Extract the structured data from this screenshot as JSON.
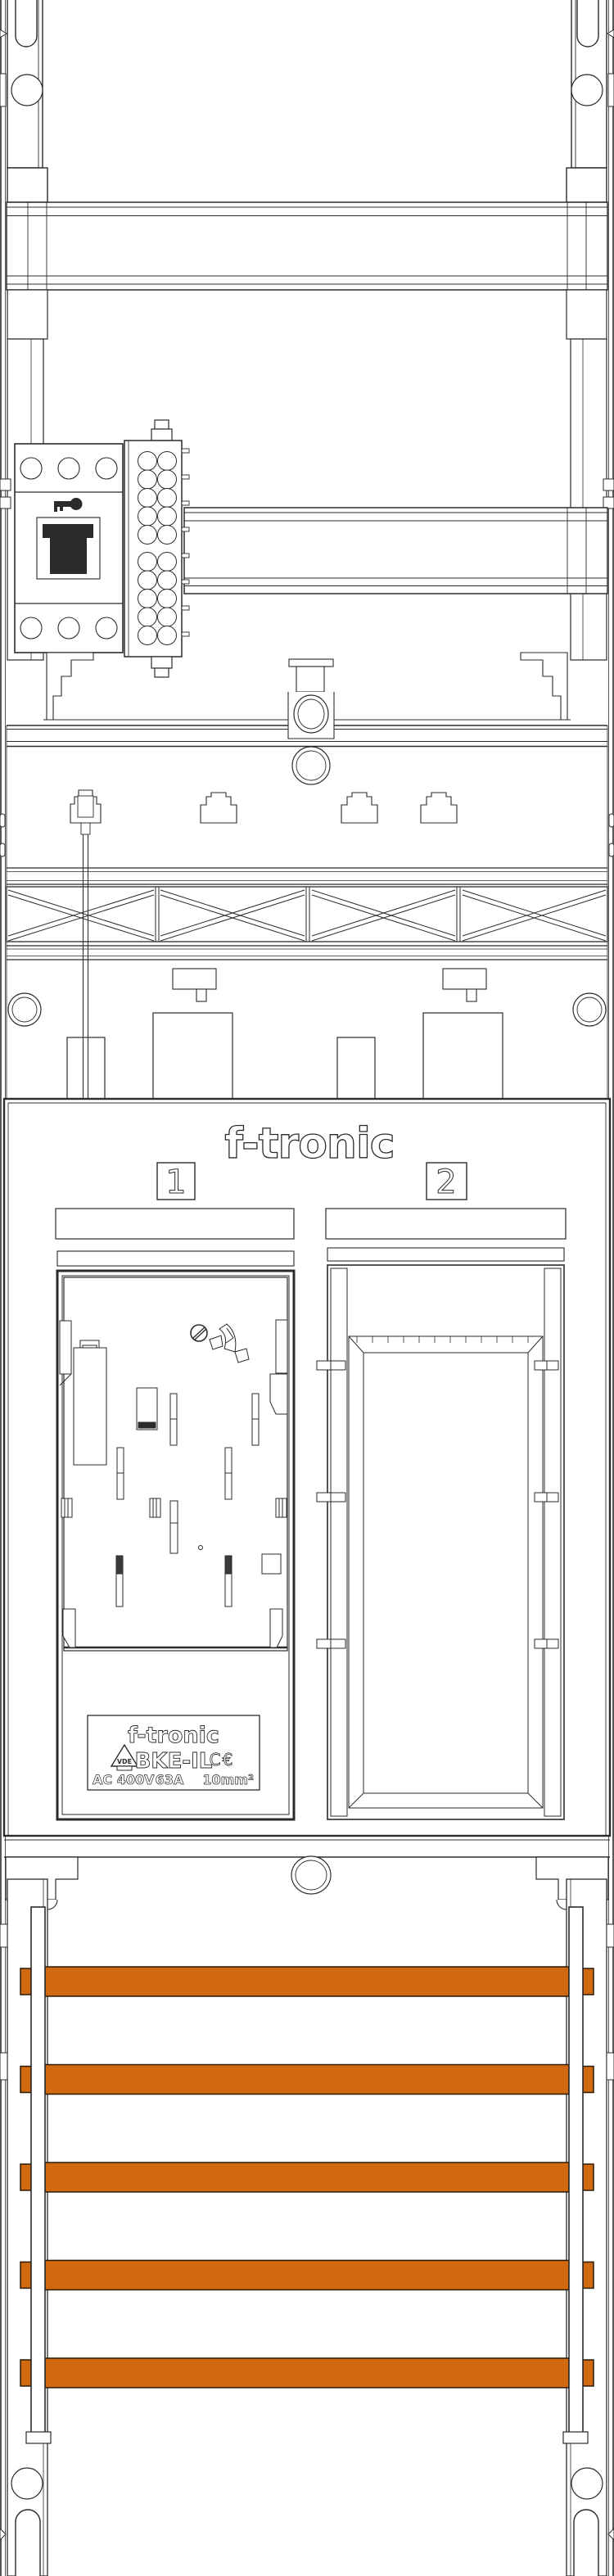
{
  "brand_logo": "f-tronic",
  "field_tags": {
    "left": "1",
    "right": "2"
  },
  "nameplate": {
    "brand": "f-tronic",
    "model": "BKE-IL",
    "vde": "VDE",
    "ce": "C€",
    "rating_voltage": "AC 400V",
    "rating_current": "63A",
    "rating_cross_section": "10mm²"
  },
  "busbars": {
    "count": 5
  },
  "colors": {
    "busbar": "#D0690F",
    "busbar_border": "#2B1B06",
    "line": "#2B2B2B"
  }
}
